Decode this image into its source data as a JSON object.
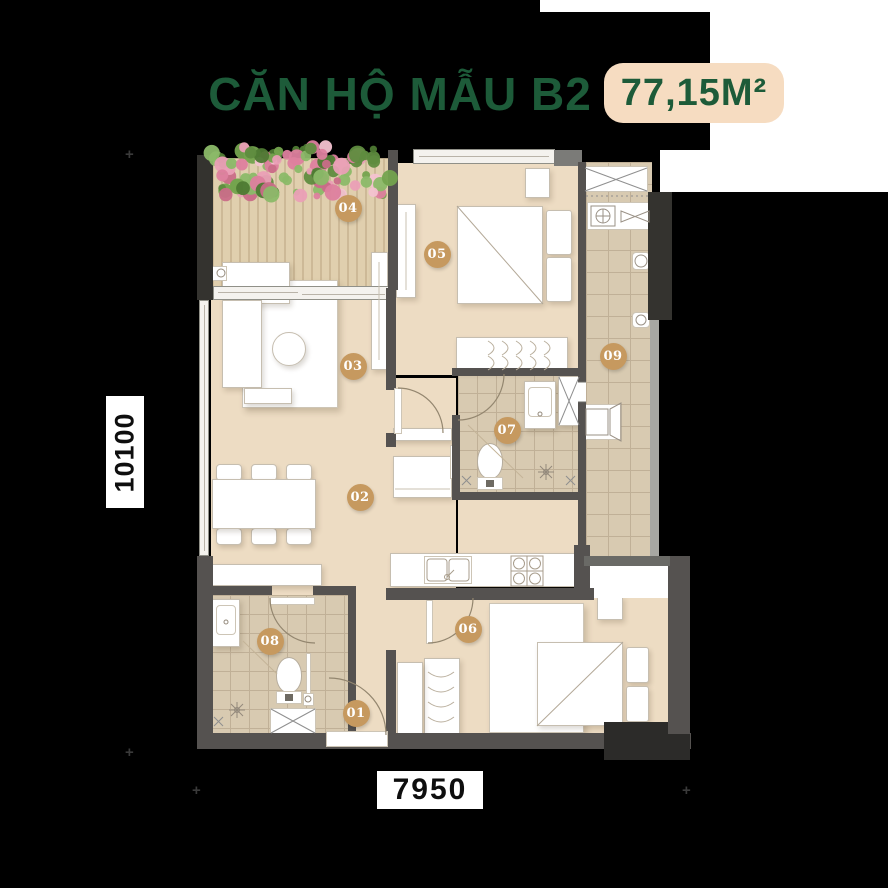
{
  "header": {
    "title": "CĂN HỘ MẪU B2",
    "area": "77,15M²"
  },
  "dimensions": {
    "vertical": "10100",
    "horizontal": "7950"
  },
  "room_markers": [
    {
      "num": "01",
      "x": 356,
      "y": 713
    },
    {
      "num": "02",
      "x": 360,
      "y": 497
    },
    {
      "num": "03",
      "x": 353,
      "y": 366
    },
    {
      "num": "04",
      "x": 348,
      "y": 208
    },
    {
      "num": "05",
      "x": 437,
      "y": 254
    },
    {
      "num": "06",
      "x": 468,
      "y": 629
    },
    {
      "num": "07",
      "x": 507,
      "y": 430
    },
    {
      "num": "08",
      "x": 270,
      "y": 641
    },
    {
      "num": "09",
      "x": 613,
      "y": 356
    }
  ],
  "colors": {
    "title_green": "#1d5b39",
    "badge_bg": "#f6dcc1",
    "marker_tan": "#c6995f",
    "floor_beige": "#eddcc3",
    "tile_beige": "#d8cab1",
    "tile_line": "#c0b097",
    "wall_gray": "#555250",
    "flower_palette": [
      "#5f8c3f",
      "#74a34e",
      "#8bb968",
      "#4e7a33",
      "#ea9fb6",
      "#dd7f9e",
      "#f3c2d0",
      "#c96d88"
    ]
  }
}
